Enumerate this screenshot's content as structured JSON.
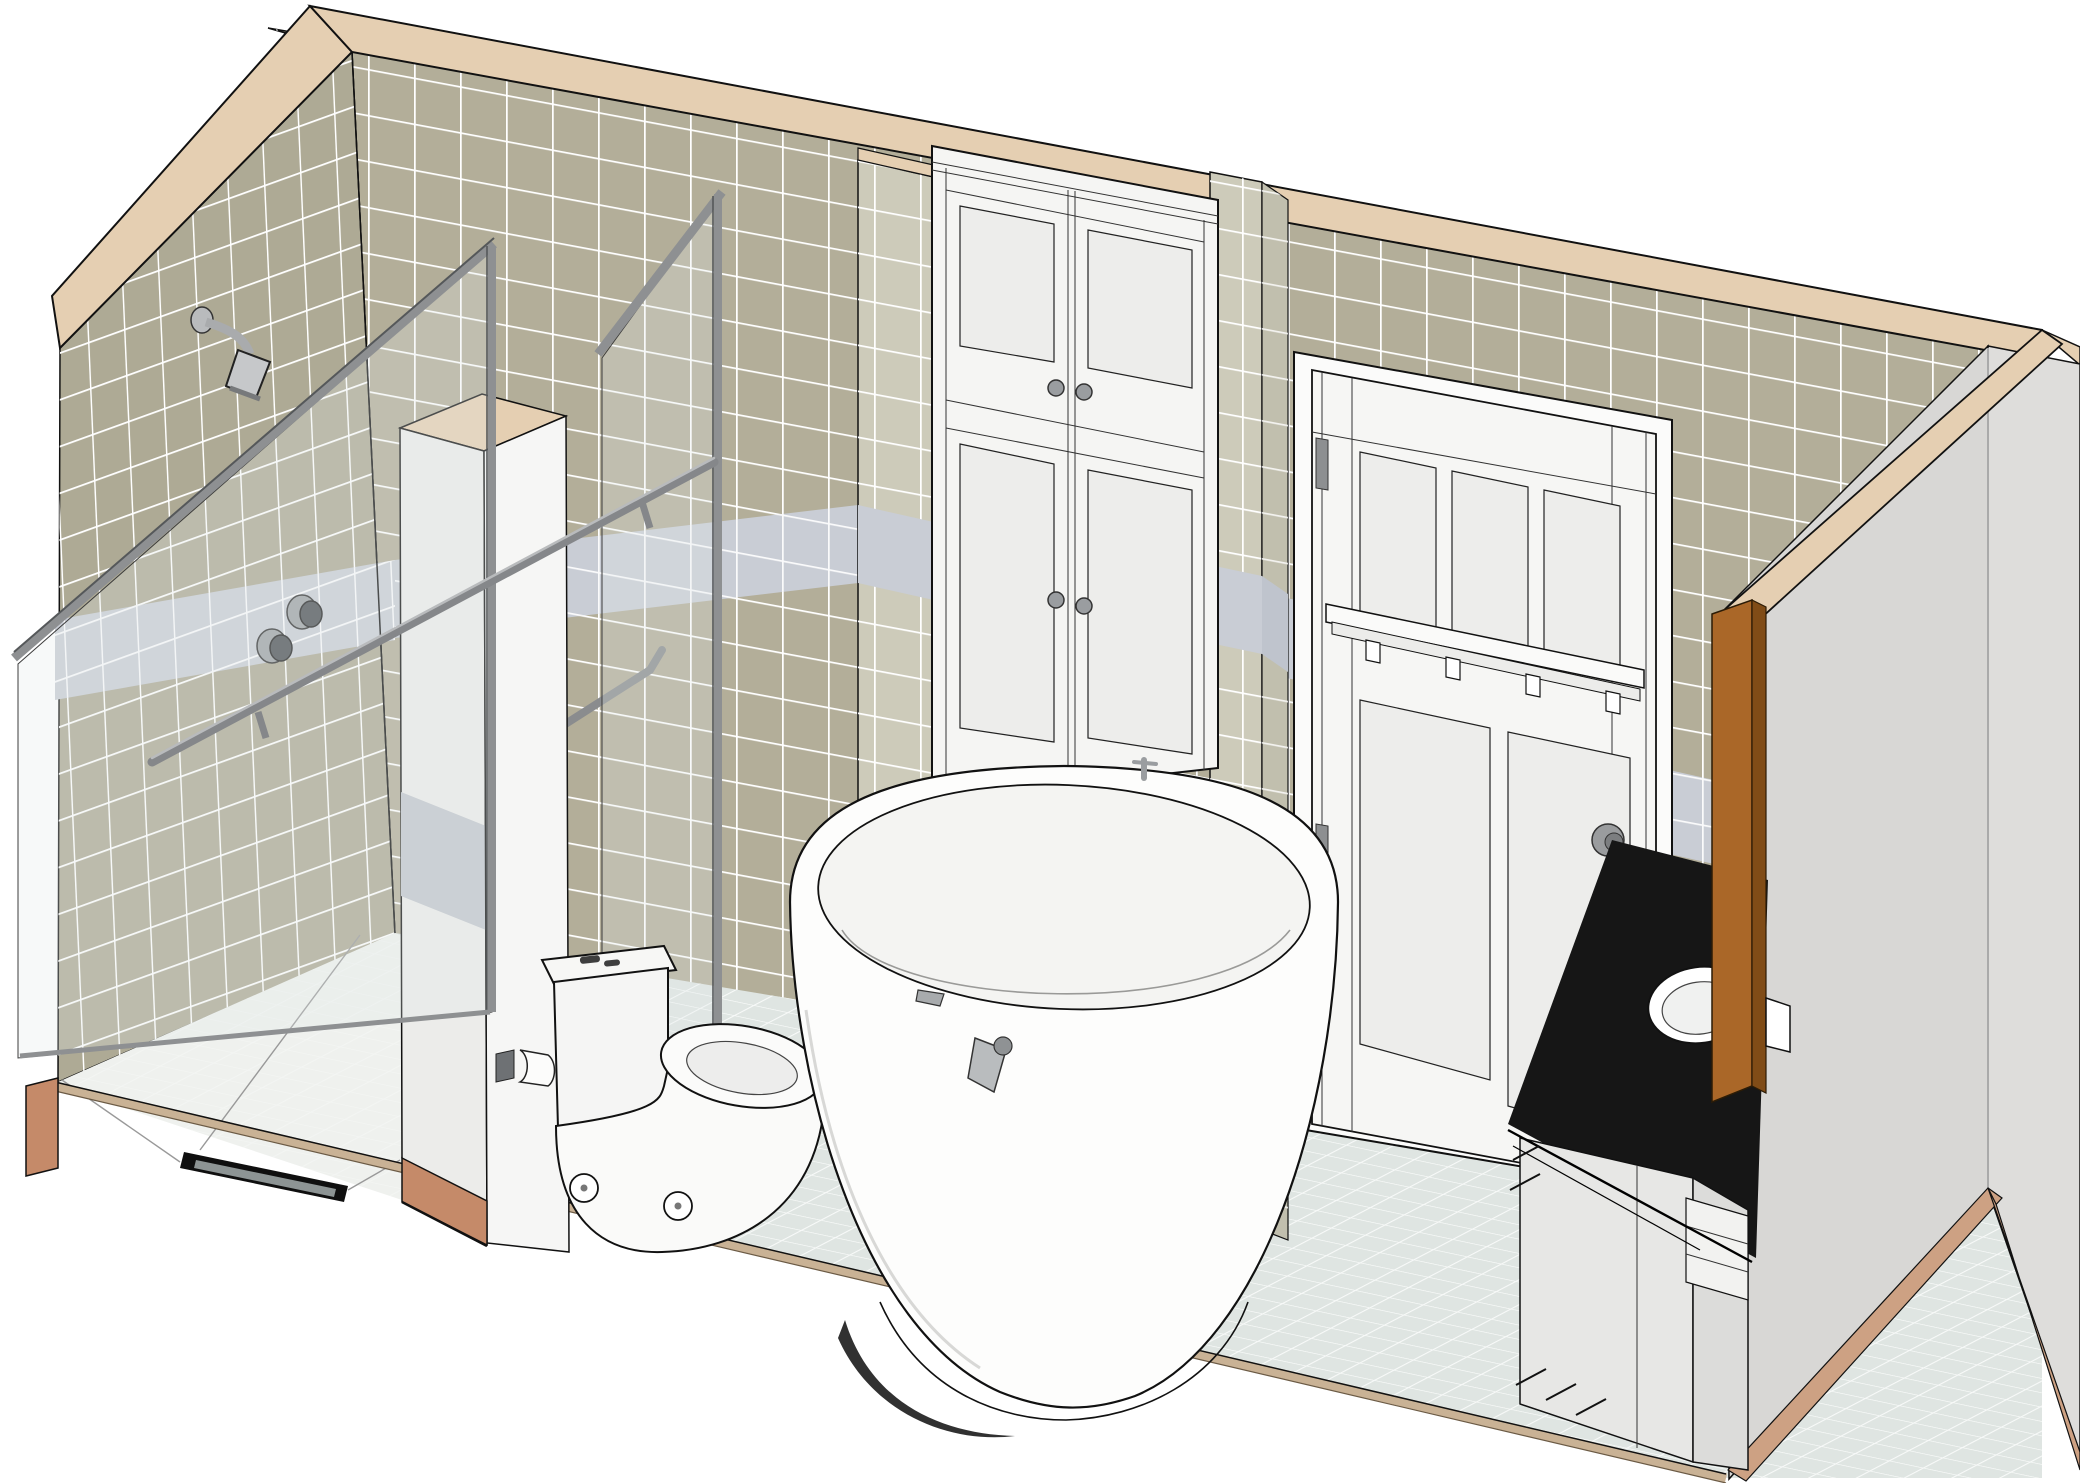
{
  "meta": {
    "view_type": "3d-perspective-cutaway-rendering",
    "scene": "bathroom",
    "width_px": 2080,
    "height_px": 1483,
    "visible_text": ""
  },
  "colors": {
    "background": "#ffffff",
    "tile_back_wall": "#b3ae99",
    "tile_left_wall": "#aeaa95",
    "tile_pilaster": "#cdcbba",
    "tile_pilaster_side": "#c1bfae",
    "accent_band": "#c9cdd5",
    "accent_band_dark": "#bfc4cd",
    "fascia_tan": "#e5cfb2",
    "floor_tile": "#dfe5e2",
    "shower_floor": "#eff1ee",
    "slab_edge_tan": "#c9b295",
    "section_cut_salmon": "#c58a69",
    "right_wall": "#d8d7d5",
    "right_wall_outer": "#dedddb",
    "right_wall_strip_tan": "#cda183",
    "fixture_white": "#f7f7f5",
    "fixture_panel": "#ededeb",
    "cabinet_white": "#f5f5f3",
    "door_white": "#f6f6f4",
    "partition_front": "#ececea",
    "partition_side": "#f6f6f5",
    "counter_black": "#161616",
    "mirror_wood": "#aa6728",
    "mirror_wood_edge": "#804c17",
    "metal": "#8e9092",
    "metal_dark": "#4e5256",
    "drain_dark": "#0f0f0f",
    "drain_inner": "#8d9494",
    "glass_tint": "rgba(226,235,235,0.28)"
  },
  "fixtures": {
    "shower_head": "wall-mounted shower head",
    "shower_controls": "two shower control knobs on accent band",
    "glass_enclosure": "framed glass shower enclosure with towel bar",
    "grab_bar": "glass door handle bar",
    "partition_wall": "half-height partition with tan cap and paper holder",
    "toilet": "two-piece toilet, side view",
    "bathtub": "freestanding oval soaking tub with rim-mounted filler",
    "storage_cabinet": "tall recessed double-door linen cabinet with upper doors",
    "entry_door": "white craftsman door with hook rail, pegs, hinges and knob",
    "mirror": "wood-framed mirror seen edge-on",
    "vanity": "vanity with black countertop, round sink and gray base",
    "floor_drain": "linear shower drain"
  }
}
